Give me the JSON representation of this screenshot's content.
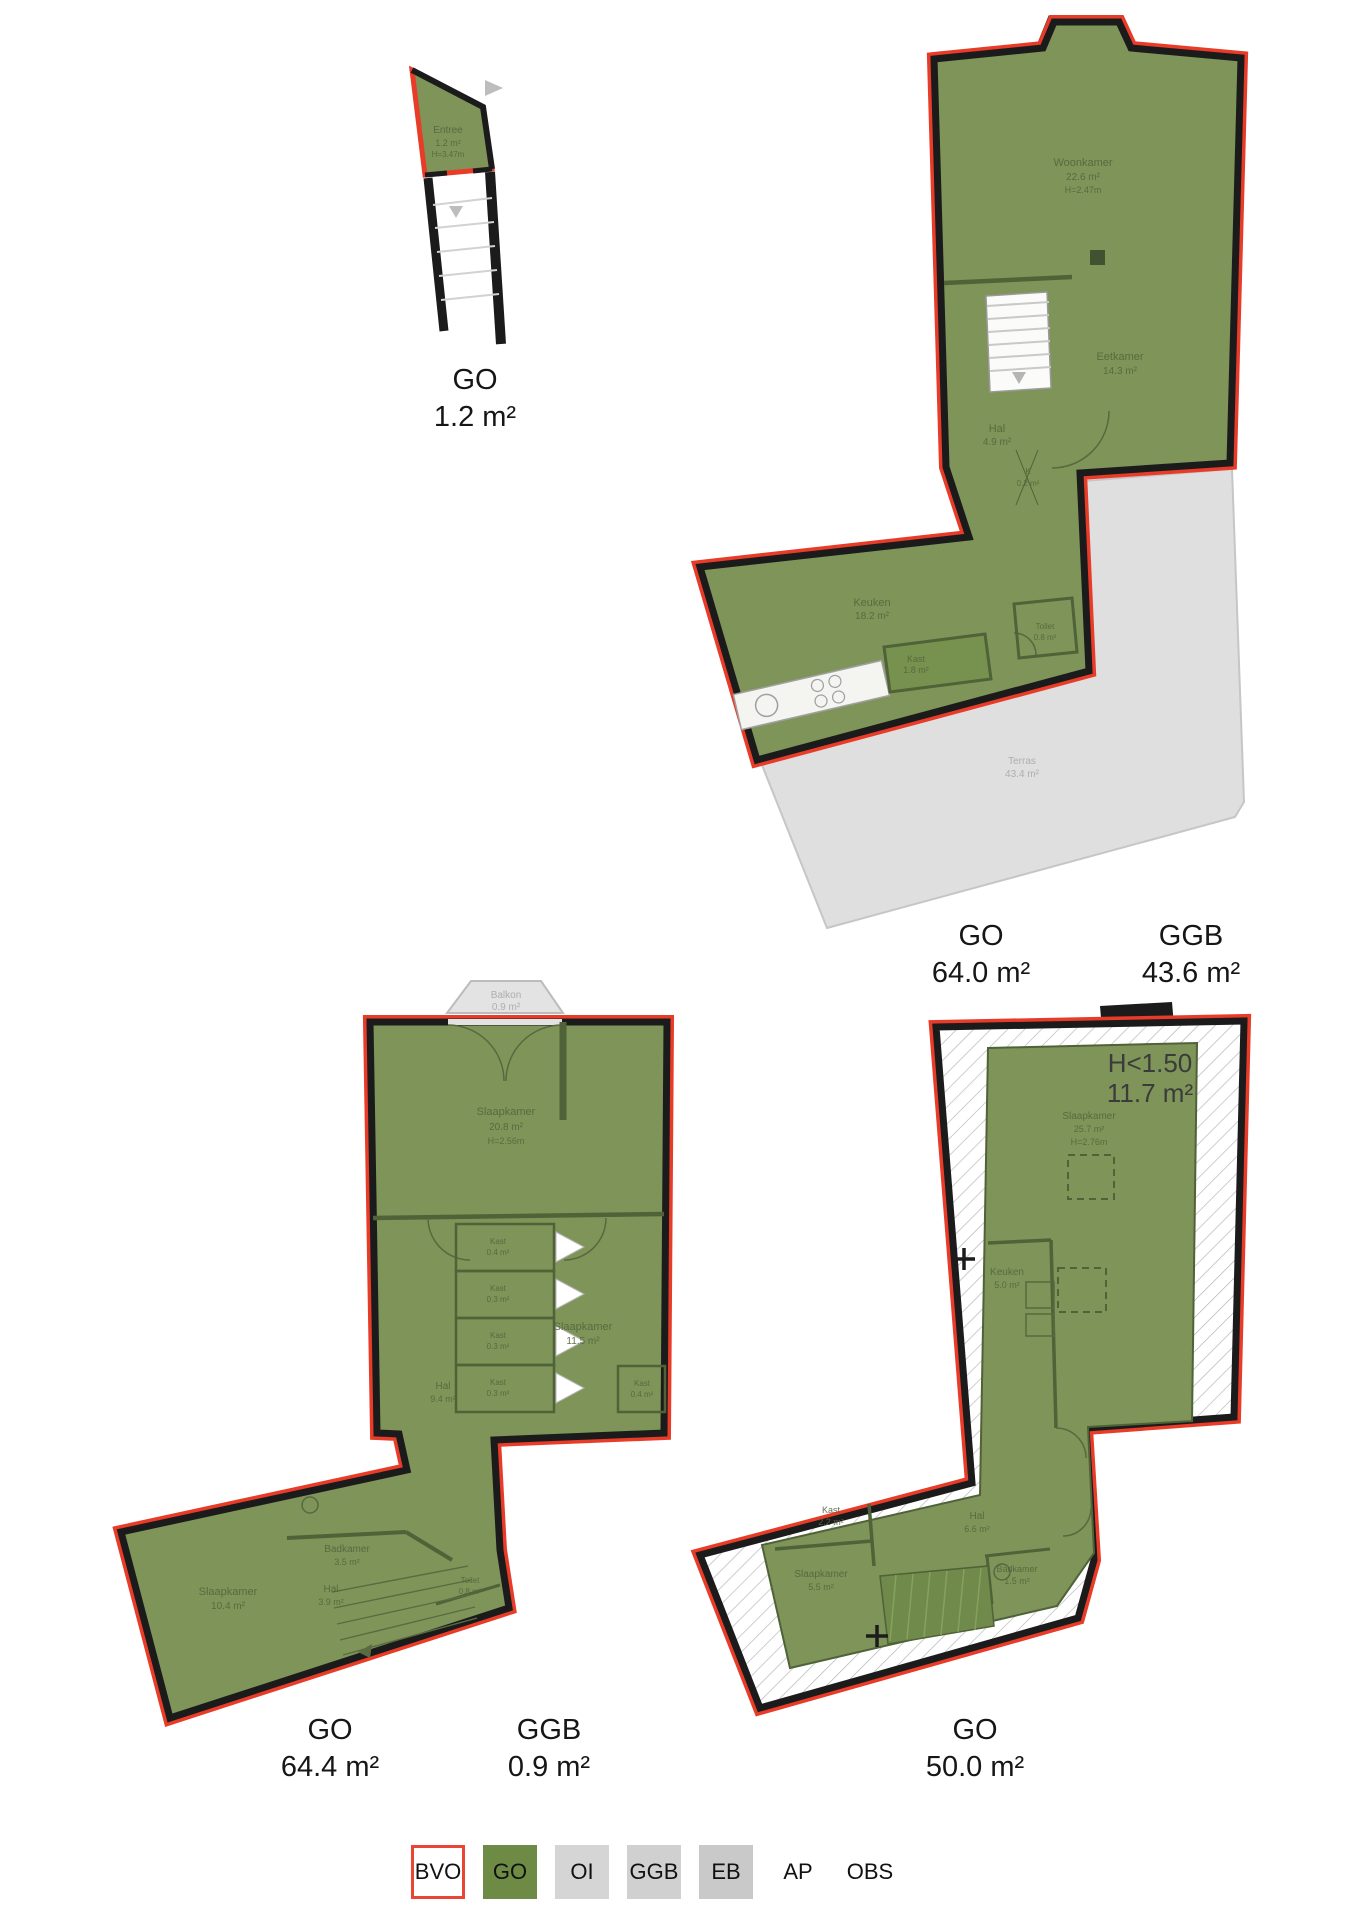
{
  "colors": {
    "go_fill": "#7e9458",
    "legend_go": "#6d8b45",
    "outline_red": "#e83c28",
    "wall_black": "#1b1b1b",
    "terrace_gray": "#dfdfdf",
    "room_text": "#55673e"
  },
  "plans": {
    "entree": {
      "rooms": {
        "entree": {
          "name": "Entree",
          "area": "1.2 m²",
          "height": "H=3.47m"
        }
      },
      "labels": {
        "go": {
          "type": "GO",
          "value": "1.2 m²"
        }
      }
    },
    "floor1": {
      "rooms": {
        "woonkamer": {
          "name": "Woonkamer",
          "area": "22.6 m²",
          "height": "H=2.47m"
        },
        "eetkamer": {
          "name": "Eetkamer",
          "area": "14.3 m²"
        },
        "hal": {
          "name": "Hal",
          "area": "4.9 m²"
        },
        "k": {
          "name": "K",
          "area": "0.2 m²"
        },
        "keuken": {
          "name": "Keuken",
          "area": "18.2 m²"
        },
        "kast": {
          "name": "Kast",
          "area": "1.8 m²"
        },
        "toilet": {
          "name": "Toilet",
          "area": "0.8 m²"
        },
        "terras": {
          "name": "Terras",
          "area": "43.4 m²"
        }
      },
      "labels": {
        "go": {
          "type": "GO",
          "value": "64.0 m²"
        },
        "ggb": {
          "type": "GGB",
          "value": "43.6 m²"
        }
      }
    },
    "floor2": {
      "rooms": {
        "balkon": {
          "name": "Balkon",
          "area": "0.9 m²"
        },
        "slaapkamer1": {
          "name": "Slaapkamer",
          "area": "20.8 m²",
          "height": "H=2.56m"
        },
        "kast1": {
          "name": "Kast",
          "area": "0.4 m²"
        },
        "kast2": {
          "name": "Kast",
          "area": "0.3 m²"
        },
        "kast3": {
          "name": "Kast",
          "area": "0.3 m²"
        },
        "kast4": {
          "name": "Kast",
          "area": "0.3 m²"
        },
        "slaapkamer2": {
          "name": "Slaapkamer",
          "area": "11.5 m²"
        },
        "hal": {
          "name": "Hal",
          "area": "9.4 m²"
        },
        "kast5": {
          "name": "Kast",
          "area": "0.4 m²"
        },
        "badkamer": {
          "name": "Badkamer",
          "area": "3.5 m²"
        },
        "hal2": {
          "name": "Hal",
          "area": "3.9 m²"
        },
        "toilet": {
          "name": "Toilet",
          "area": "0.8 m²"
        },
        "slaapkamer3": {
          "name": "Slaapkamer",
          "area": "10.4 m²"
        }
      },
      "labels": {
        "go": {
          "type": "GO",
          "value": "64.4 m²"
        },
        "ggb": {
          "type": "GGB",
          "value": "0.9 m²"
        }
      }
    },
    "floor3": {
      "annotation": {
        "line1": "H<1.50",
        "line2": "11.7 m²"
      },
      "rooms": {
        "slaapkamer1": {
          "name": "Slaapkamer",
          "area": "25.7 m²",
          "height": "H=2.76m"
        },
        "keuken": {
          "name": "Keuken",
          "area": "5.0 m²"
        },
        "kast": {
          "name": "Kast",
          "area": "2.2 m²"
        },
        "hal": {
          "name": "Hal",
          "area": "6.6 m²"
        },
        "slaapkamer2": {
          "name": "Slaapkamer",
          "area": "5.5 m²"
        },
        "badkamer": {
          "name": "Badkamer",
          "area": "1.5 m²"
        }
      },
      "labels": {
        "go": {
          "type": "GO",
          "value": "50.0 m²"
        }
      }
    }
  },
  "legend": {
    "items": [
      {
        "label": "BVO"
      },
      {
        "label": "GO"
      },
      {
        "label": "OI"
      },
      {
        "label": "GGB"
      },
      {
        "label": "EB"
      },
      {
        "label": "AP"
      },
      {
        "label": "OBS"
      }
    ]
  }
}
